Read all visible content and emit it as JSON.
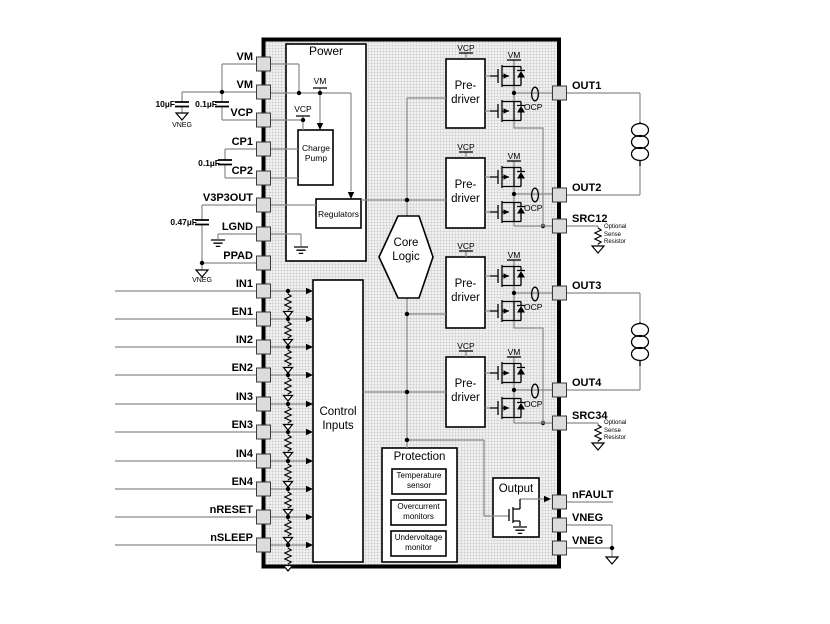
{
  "pins": {
    "left": [
      "VM",
      "VM",
      "VCP",
      "CP1",
      "CP2",
      "V3P3OUT",
      "LGND",
      "PPAD",
      "IN1",
      "EN1",
      "IN2",
      "EN2",
      "IN3",
      "EN3",
      "IN4",
      "EN4",
      "nRESET",
      "nSLEEP"
    ],
    "right": [
      "OUT1",
      "OUT2",
      "SRC12",
      "OUT3",
      "OUT4",
      "SRC34",
      "nFAULT",
      "VNEG",
      "VNEG"
    ]
  },
  "blocks": {
    "power": "Power",
    "charge_pump": "Charge Pump",
    "regulators": "Regulators",
    "core_logic": "Core Logic",
    "control_inputs": "Control Inputs",
    "predriver": "Pre-driver",
    "protection": "Protection",
    "temperature_sensor": "Temperature sensor",
    "overcurrent_monitors": "Overcurrent monitors",
    "undervoltage_monitor": "Undervoltage monitor",
    "output": "Output"
  },
  "rails": {
    "vcp": "VCP",
    "vm": "VM"
  },
  "labels": {
    "ocp": "OCP",
    "vneg": "VNEG",
    "optional_sense": "Optional Sense Resistor"
  },
  "caps": {
    "vm_bulk": "10µF",
    "vm_bypass": "0.1µF",
    "charge_pump_flying": "0.1µF",
    "v3p3_bypass": "0.47µF"
  },
  "colors": {
    "wire": "#8a8a8a",
    "symbol": "#000000",
    "ic_fill": "#f0f0f0",
    "pin_fill": "#dcdcdc"
  }
}
